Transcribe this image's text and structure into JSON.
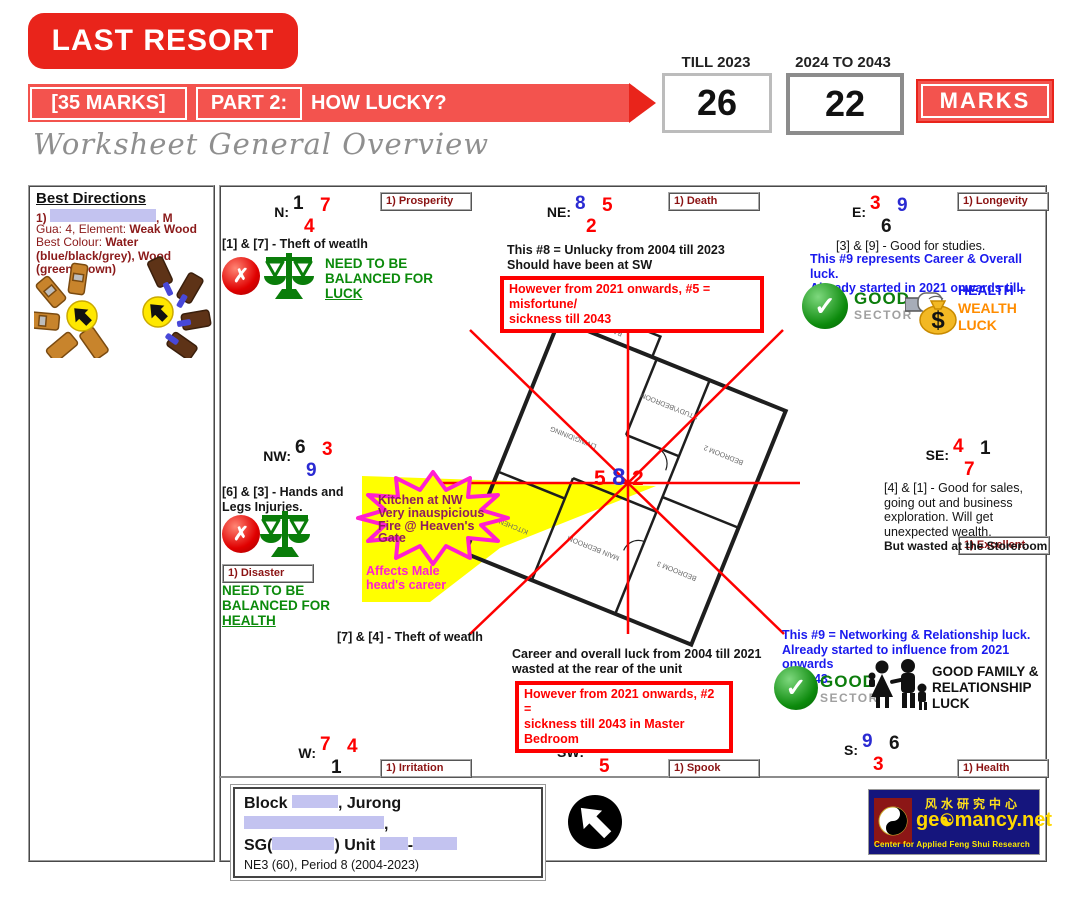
{
  "header": {
    "badge": "LAST RESORT",
    "marks_bracket": "[35 MARKS]",
    "part_label": "PART 2:",
    "question": "HOW LUCKY?",
    "col1_label": "TILL 2023",
    "col1_value": "26",
    "col2_label": "2024 TO 2043",
    "col2_value": "22",
    "marks_word": "MARKS",
    "subtitle": "Worksheet General Overview"
  },
  "best_directions": {
    "title": "Best Directions",
    "person_prefix": "1)",
    "person_suffix": ", M",
    "gua_prefix": "Gua: 4, Element: ",
    "gua_bold": "Weak Wood",
    "colour_prefix": "Best Colour: ",
    "colour_bold": "Water (blue/black/grey), Wood (green/brown)"
  },
  "sectors": {
    "n": {
      "label": "N:",
      "t1": "1",
      "t1c": "#161616",
      "t2": "7",
      "t2c": "#fe0000",
      "b": "4",
      "bc": "#fe0000",
      "tag": "1) Prosperity"
    },
    "ne": {
      "label": "NE:",
      "t1": "8",
      "t1c": "#2a2ad2",
      "t2": "5",
      "t2c": "#fe0000",
      "b": "2",
      "bc": "#fe0000",
      "tag": "1) Death"
    },
    "e": {
      "label": "E:",
      "t1": "3",
      "t1c": "#fe0000",
      "t2": "9",
      "t2c": "#2a2ad2",
      "b": "6",
      "bc": "#161616",
      "tag": "1) Longevity"
    },
    "se": {
      "label": "SE:",
      "t1": "4",
      "t1c": "#fe0000",
      "t2": "1",
      "t2c": "#161616",
      "b": "7",
      "bc": "#fe0000",
      "tag": "1) Excellent"
    },
    "s": {
      "label": "S:",
      "t1": "9",
      "t1c": "#2a2ad2",
      "t2": "6",
      "t2c": "#161616",
      "b": "3",
      "bc": "#fe0000",
      "tag": "1) Health"
    },
    "sw": {
      "label": "SW:",
      "t1": "2",
      "t1c": "#fe0000",
      "t2": "8",
      "t2c": "#2a2ad2",
      "b": "5",
      "bc": "#fe0000",
      "tag": "1) Spook"
    },
    "w": {
      "label": "W:",
      "t1": "7",
      "t1c": "#fe0000",
      "t2": "4",
      "t2c": "#fe0000",
      "b": "1",
      "bc": "#161616",
      "tag": "1) Irritation"
    },
    "nw": {
      "label": "NW:",
      "t1": "6",
      "t1c": "#161616",
      "t2": "3",
      "t2c": "#fe0000",
      "b": "9",
      "bc": "#2a2ad2",
      "tag": "1) Disaster"
    }
  },
  "center_stars": {
    "s1": "5",
    "s1c": "#fe0000",
    "s2": "8",
    "s2c": "#2a2ad2",
    "s3": "2",
    "s3c": "#fe0000"
  },
  "notes": {
    "n_pair": "[1] & [7] - Theft of weatlh",
    "n_balance_pre": "NEED TO BE BALANCED FOR ",
    "n_balance_word": "LUCK",
    "ne_line1": "This #8 = Unlucky from 2004 till 2023",
    "ne_line2": "Should have been at SW",
    "ne_alert1": "However from 2021 onwards, #5 = misfortune/",
    "ne_alert2": "sickness till 2043",
    "e_pair": "[3] & [9] - Good for studies.",
    "e_blue1": "This #9 represents Career & Overall luck.",
    "e_blue2": "Already started in 2021 onwards till 2043",
    "good_word": "GOOD",
    "sector_word": "SECTOR",
    "hw_line1": "HEALTH +",
    "hw_line2": "WEALTH",
    "hw_line3": "LUCK",
    "nw_pair": "[6] & [3] - Hands and Legs Injuries.",
    "nw_balance_pre": "NEED TO BE BALANCED FOR ",
    "nw_balance_word": "HEALTH",
    "star_line1": "Kitchen at NW",
    "star_line2": "Very inauspicious",
    "star_line3": "Fire @ Heaven's",
    "star_line4": "Gate",
    "affects1": "Affects Male",
    "affects2": "head's career",
    "sw_pair": "[7] & [4] -  Theft of weatlh",
    "career1": "Career and overall luck from 2004 till 2021",
    "career2": "wasted at the rear of the unit",
    "sw_alert1": "However from 2021 onwards, #2 =",
    "sw_alert2": "sickness till 2043 in Master Bedroom",
    "se_text": "[4] & [1] - Good for sales, going out and business exploration. Will get unexpected wealth.",
    "se_bold": "But wasted at the Storeroom",
    "s9_line1": "This #9 = Networking & Relationship luck.",
    "s9_line2": "Already started to influence from 2021 onwards",
    "s9_line3": "till 2043",
    "family1": "GOOD FAMILY &",
    "family2": "RELATIONSHIP",
    "family3": "LUCK"
  },
  "floorplan": {
    "rooms": [
      "BALCONY",
      "STUDY\\BEDROOM",
      "LIVING\\DINING",
      "BEDROOM 2",
      "KITCHEN",
      "MAIN BEDROOM",
      "BEDROOM 3"
    ]
  },
  "footer": {
    "addr1_a": "Block ",
    "addr1_b": ", Jurong ",
    "addr1_c": ",",
    "addr2_a": "SG(",
    "addr2_b": ") Unit ",
    "addr2_c": "-",
    "meta": "NE3 (60), Period 8 (2004-2023)"
  },
  "logo": {
    "chinese": "风水研究中心",
    "domain_pre": "ge",
    "domain_yin": "☯",
    "domain_post": "mancy.net",
    "caption": "Center for Applied Feng Shui Research"
  },
  "colors": {
    "accent_red": "#e9241b",
    "banner_red": "#f3534e",
    "star_red": "#fe0000",
    "star_blue": "#2a2ad2",
    "good_green": "#0c7d0c",
    "warn_magenta": "#ff1fd0",
    "highlight_yellow": "#ffff00"
  }
}
